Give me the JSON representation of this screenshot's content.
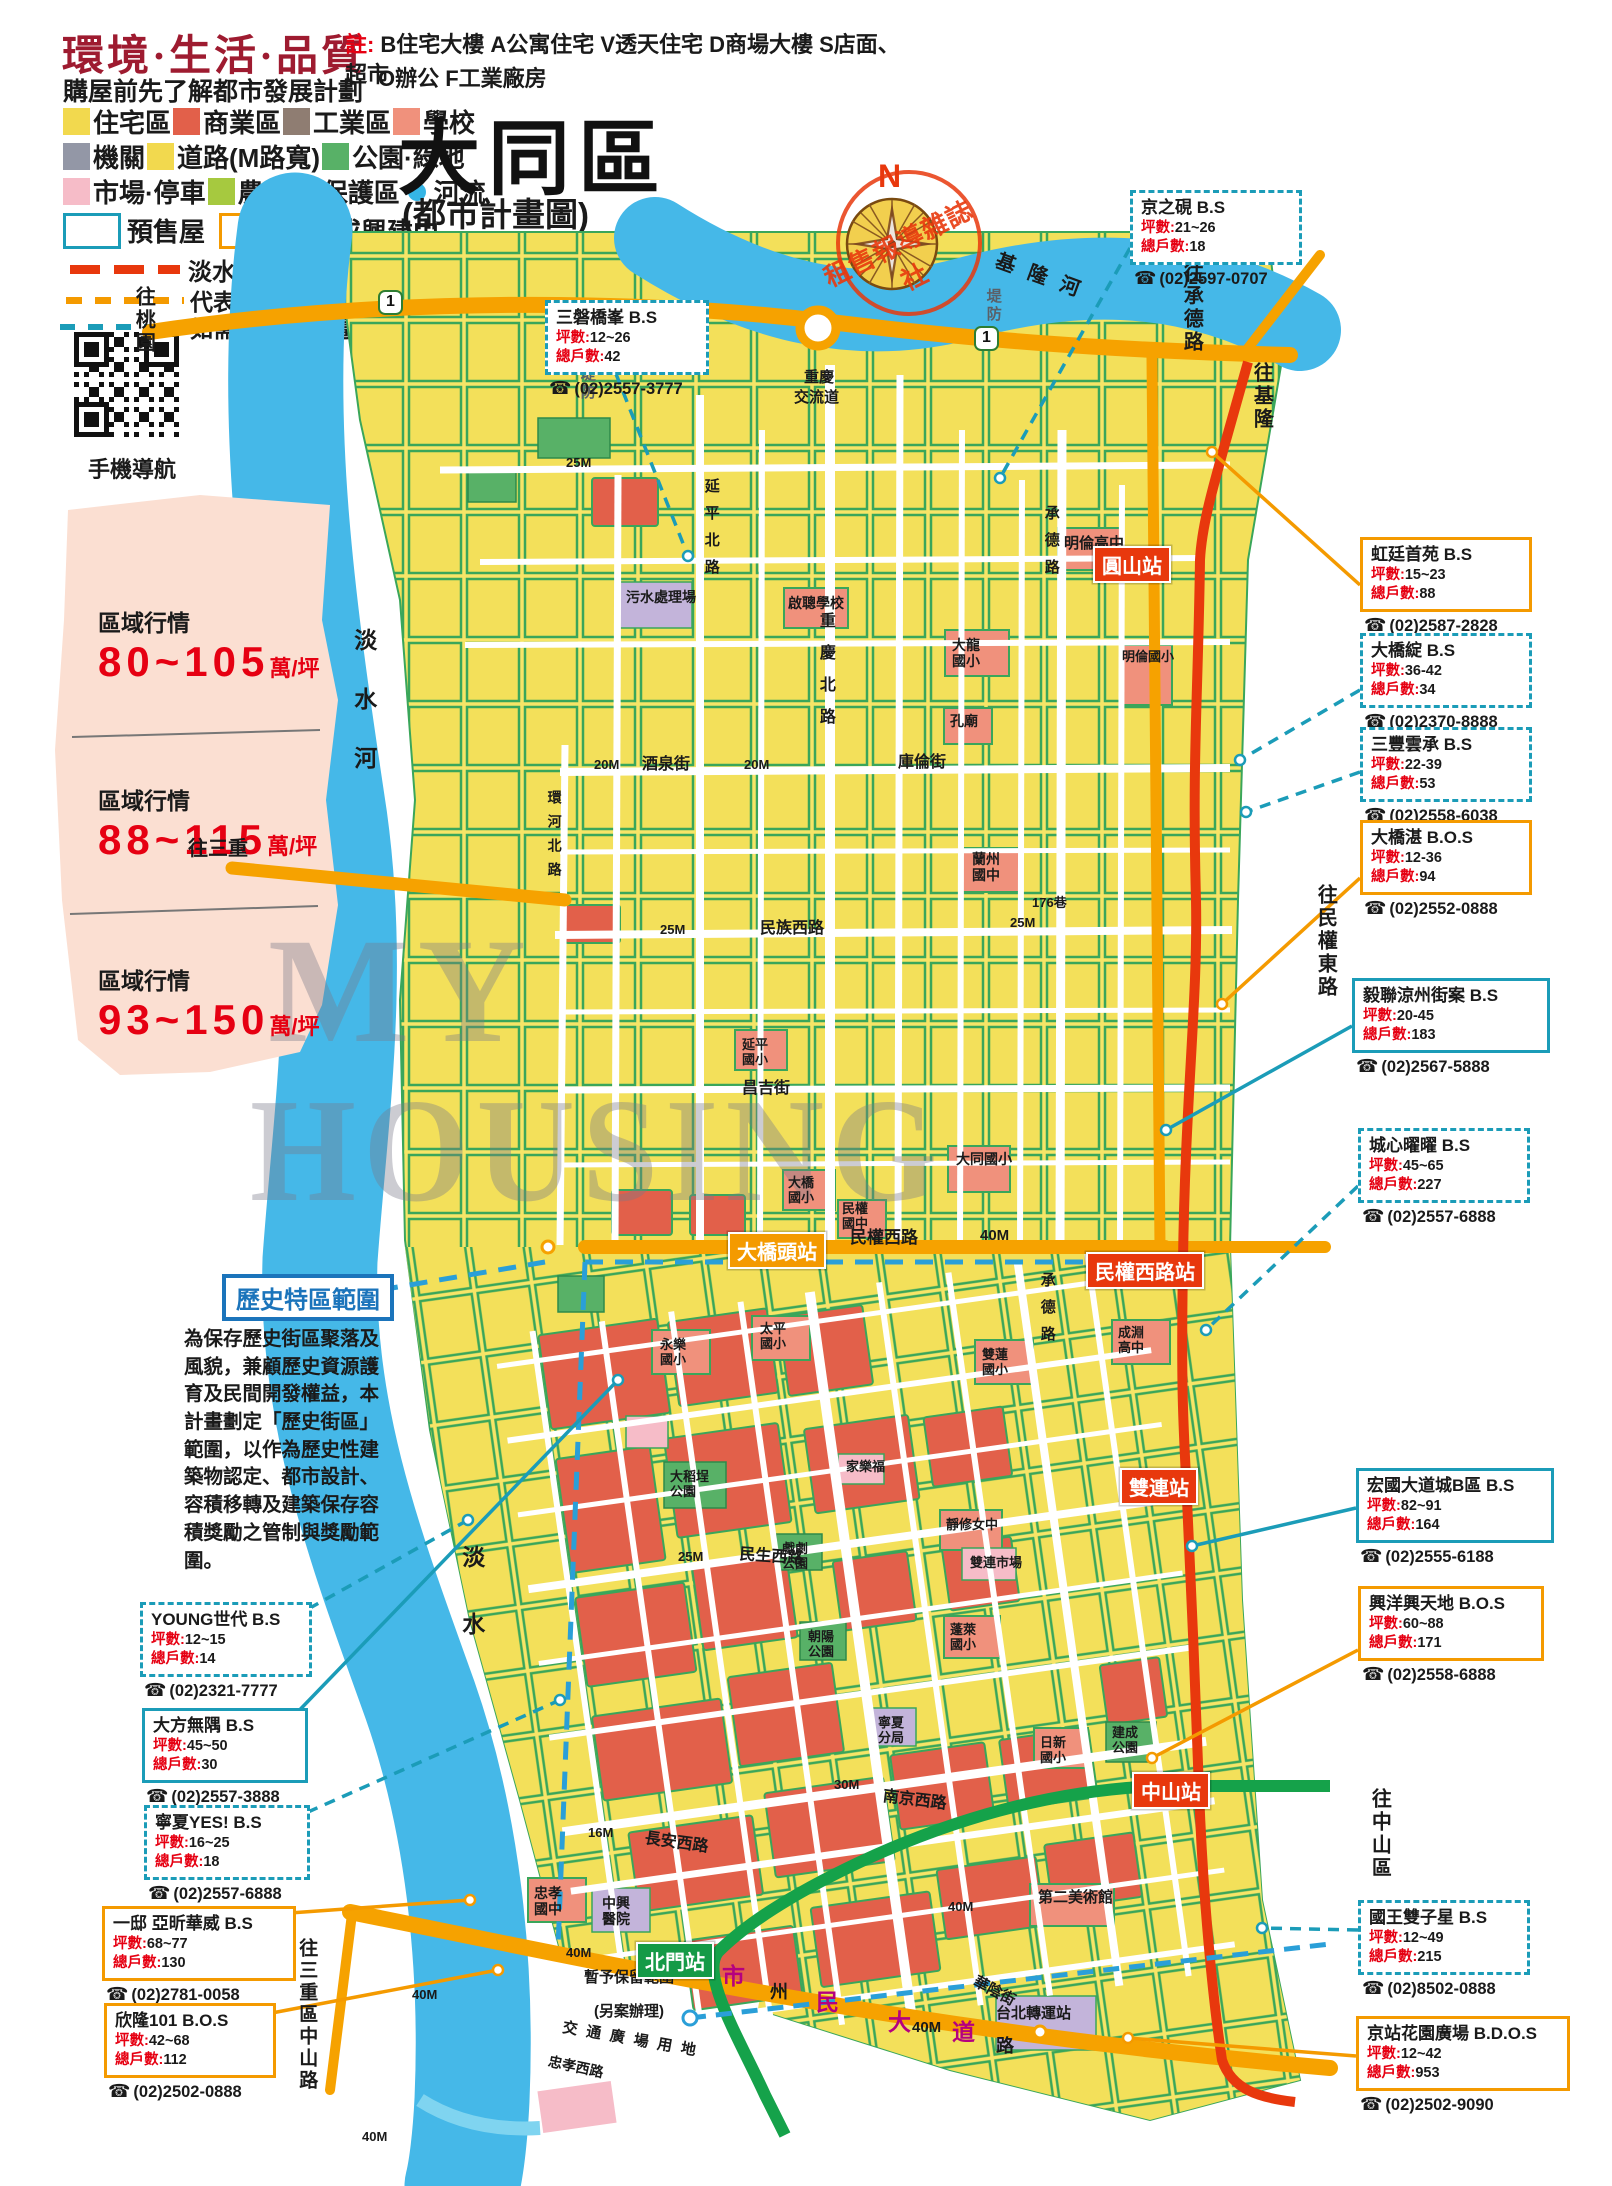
{
  "header": {
    "title": "環境·生活·品質",
    "subtitle": "購屋前先了解都市發展計劃",
    "note_label": "註:",
    "note1": "B住宅大樓 A公寓住宅 V透天住宅 D商場大樓 S店面、超市",
    "note2": "O辦公 F工業廠房",
    "qr_label": "手機導航"
  },
  "map_title": {
    "main": "大同區",
    "sub": "(都市計畫圖)",
    "compass_n": "N",
    "stamp": "租售報導雜誌社"
  },
  "legend": {
    "rows": [
      {
        "items": [
          {
            "sw": "#f2d94e",
            "label": "住宅區"
          },
          {
            "sw": "#e2604a",
            "label": "商業區"
          },
          {
            "sw": "#8f7d72",
            "label": "工業區"
          },
          {
            "sw": "#f0917c",
            "label": "學校"
          }
        ]
      },
      {
        "items": [
          {
            "sw": "#9397a6",
            "label": "機關"
          },
          {
            "sw": "#f2d94e",
            "label": "道路(M路寬)"
          },
          {
            "sw": "#58b167",
            "label": "公園·綠地"
          }
        ]
      },
      {
        "items": [
          {
            "sw": "#f6bcc8",
            "label": "市場·停車"
          },
          {
            "sw": "#a6c93f",
            "label": "農業"
          },
          {
            "sw": "dots",
            "label": "保護區"
          },
          {
            "sw": "drop",
            "label": "河流"
          }
        ]
      }
    ],
    "presale": {
      "color": "#1b9cb8",
      "label": "預售屋"
    },
    "built": {
      "color": "#f49a00",
      "label": "成屋或興建中"
    },
    "mrt_label": "淡水線／信義線",
    "note1": "代表接待中心不在基地位置上，",
    "note2": "如需前往請先電洽。"
  },
  "price_zones": [
    {
      "label": "區域行情",
      "range": "80~105",
      "unit": "萬/坪"
    },
    {
      "label": "區域行情",
      "range": "88~115",
      "unit": "萬/坪"
    },
    {
      "label": "區域行情",
      "range": "93~150",
      "unit": "萬/坪"
    }
  ],
  "historic": {
    "title": "歷史特區範圍",
    "body": "為保存歷史街區聚落及風貌，兼顧歷史資源護育及民間開發權益，本計畫劃定「歷史街區」範圍，以作為歷史性建築物認定、都市設計、容積移轉及建築保存容積獎勵之管制與獎勵範圍。"
  },
  "watermark": {
    "line1": "MY",
    "line2": "HOUSING"
  },
  "fields": {
    "ping": "坪數:",
    "units": "總戶數:",
    "phone_icon": "☎"
  },
  "colors": {
    "accent_red": "#e8380d",
    "accent_orange": "#f49a00",
    "accent_teal": "#1b9cb8",
    "price_red": "#e60012",
    "title_red": "#9e1b30",
    "historic_blue": "#1b74bb"
  },
  "listings": [
    {
      "name": "京之硯",
      "grade": "B.S",
      "ping": "21~26",
      "units": "18",
      "phone": "(02)2597-0707",
      "style": "d",
      "x": 1130,
      "y": 190,
      "w": 150,
      "lx": 1130,
      "ly": 248,
      "tx": 1000,
      "ty": 478
    },
    {
      "name": "三磐橋峯",
      "grade": "B.S",
      "ping": "12~26",
      "units": "42",
      "phone": "(02)2557-3777",
      "style": "d",
      "x": 545,
      "y": 300,
      "w": 142,
      "lx": 616,
      "ly": 374,
      "tx": 688,
      "ty": 556
    },
    {
      "name": "虹廷首苑",
      "grade": "B.S",
      "ping": "15~23",
      "units": "88",
      "phone": "(02)2587-2828",
      "style": "o",
      "x": 1360,
      "y": 537,
      "w": 150,
      "lx": 1360,
      "ly": 585,
      "tx": 1212,
      "ty": 452
    },
    {
      "name": "大橋綻",
      "grade": "B.S",
      "ping": "36-42",
      "units": "34",
      "phone": "(02)2370-8888",
      "style": "d",
      "x": 1360,
      "y": 633,
      "w": 150,
      "lx": 1360,
      "ly": 690,
      "tx": 1240,
      "ty": 760
    },
    {
      "name": "三豐雲承",
      "grade": "B.S",
      "ping": "22-39",
      "units": "53",
      "phone": "(02)2558-6038",
      "style": "d",
      "x": 1360,
      "y": 727,
      "w": 150,
      "lx": 1360,
      "ly": 772,
      "tx": 1246,
      "ty": 812
    },
    {
      "name": "大橋湛",
      "grade": "B.O.S",
      "ping": "12-36",
      "units": "94",
      "phone": "(02)2552-0888",
      "style": "o",
      "x": 1360,
      "y": 820,
      "w": 150,
      "lx": 1360,
      "ly": 878,
      "tx": 1222,
      "ty": 1004
    },
    {
      "name": "毅聯涼州街案",
      "grade": "B.S",
      "ping": "20-45",
      "units": "183",
      "phone": "(02)2567-5888",
      "style": "t",
      "x": 1352,
      "y": 978,
      "w": 176,
      "lx": 1352,
      "ly": 1026,
      "tx": 1166,
      "ty": 1130
    },
    {
      "name": "城心曜曜",
      "grade": "B.S",
      "ping": "45~65",
      "units": "227",
      "phone": "(02)2557-6888",
      "style": "d",
      "x": 1358,
      "y": 1128,
      "w": 150,
      "lx": 1358,
      "ly": 1186,
      "tx": 1206,
      "ty": 1330
    },
    {
      "name": "宏國大道城B區",
      "grade": "B.S",
      "ping": "82~91",
      "units": "164",
      "phone": "(02)2555-6188",
      "style": "t",
      "x": 1356,
      "y": 1468,
      "w": 176,
      "lx": 1356,
      "ly": 1508,
      "tx": 1192,
      "ty": 1546
    },
    {
      "name": "興洋興天地",
      "grade": "B.O.S",
      "ping": "60~88",
      "units": "171",
      "phone": "(02)2558-6888",
      "style": "o",
      "x": 1358,
      "y": 1586,
      "w": 164,
      "lx": 1358,
      "ly": 1650,
      "tx": 1152,
      "ty": 1758
    },
    {
      "name": "國王雙子星",
      "grade": "B.S",
      "ping": "12~49",
      "units": "215",
      "phone": "(02)8502-0888",
      "style": "d",
      "x": 1358,
      "y": 1900,
      "w": 150,
      "lx": 1358,
      "ly": 1930,
      "tx": 1262,
      "ty": 1928
    },
    {
      "name": "京站花園廣場",
      "grade": "B.D.O.S",
      "ping": "12~42",
      "units": "953",
      "phone": "(02)2502-9090",
      "style": "o",
      "x": 1356,
      "y": 2016,
      "w": 192,
      "lx": 1356,
      "ly": 2056,
      "tx": 1128,
      "ty": 2038
    },
    {
      "name": "YOUNG世代",
      "grade": "B.S",
      "ping": "12~15",
      "units": "14",
      "phone": "(02)2321-7777",
      "style": "d",
      "x": 140,
      "y": 1602,
      "w": 150,
      "lx": 292,
      "ly": 1618,
      "tx": 468,
      "ty": 1520
    },
    {
      "name": "大方無隅",
      "grade": "B.S",
      "ping": "45~50",
      "units": "30",
      "phone": "(02)2557-3888",
      "style": "t",
      "x": 142,
      "y": 1708,
      "w": 144,
      "lx": 288,
      "ly": 1722,
      "tx": 618,
      "ty": 1380
    },
    {
      "name": "寧夏YES!",
      "grade": "B.S",
      "ping": "16~25",
      "units": "18",
      "phone": "(02)2557-6888",
      "style": "d",
      "x": 144,
      "y": 1805,
      "w": 144,
      "lx": 290,
      "ly": 1820,
      "tx": 560,
      "ty": 1700
    },
    {
      "name": "一邸 亞昕華威",
      "grade": "B.S",
      "ping": "68~77",
      "units": "130",
      "phone": "(02)2781-0058",
      "style": "o",
      "x": 102,
      "y": 1906,
      "w": 172,
      "lx": 276,
      "ly": 1914,
      "tx": 470,
      "ty": 1900
    },
    {
      "name": "欣隆101",
      "grade": "B.O.S",
      "ping": "42~68",
      "units": "112",
      "phone": "(02)2502-0888",
      "style": "o",
      "x": 104,
      "y": 2003,
      "w": 150,
      "lx": 256,
      "ly": 2016,
      "tx": 498,
      "ty": 1970
    }
  ],
  "stations": [
    {
      "label": "圓山站",
      "x": 1093,
      "y": 546,
      "cls": "st-red"
    },
    {
      "label": "大橋頭站",
      "x": 728,
      "y": 1232,
      "cls": "st-orange"
    },
    {
      "label": "民權西路站",
      "x": 1086,
      "y": 1252,
      "cls": "st-red"
    },
    {
      "label": "雙連站",
      "x": 1120,
      "y": 1468,
      "cls": "st-red"
    },
    {
      "label": "中山站",
      "x": 1132,
      "y": 1772,
      "cls": "st-red"
    },
    {
      "label": "北門站",
      "x": 636,
      "y": 1942,
      "cls": "st-green"
    }
  ],
  "map_labels": [
    {
      "t": "往桃園",
      "x": 132,
      "y": 286,
      "fs": 20,
      "v": 1
    },
    {
      "t": "往承德路",
      "x": 1180,
      "y": 262,
      "fs": 20,
      "v": 1
    },
    {
      "t": "往基隆",
      "x": 1250,
      "y": 362,
      "fs": 20,
      "v": 1
    },
    {
      "t": "往三重",
      "x": 188,
      "y": 838,
      "fs": 20
    },
    {
      "t": "往民權東路",
      "x": 1314,
      "y": 884,
      "fs": 20,
      "v": 1
    },
    {
      "t": "往中山區",
      "x": 1368,
      "y": 1788,
      "fs": 20,
      "v": 1
    },
    {
      "t": "往三重區中山路",
      "x": 296,
      "y": 1938,
      "fs": 19,
      "v": 1
    },
    {
      "t": "淡水河",
      "x": 350,
      "y": 628,
      "fs": 23,
      "v": 1,
      "sp": 36
    },
    {
      "t": "淡水",
      "x": 458,
      "y": 1545,
      "fs": 23,
      "v": 1,
      "sp": 44
    },
    {
      "t": "基隆河",
      "x": 1000,
      "y": 250,
      "fs": 20,
      "r": 20,
      "sp": 14
    },
    {
      "t": "堤防",
      "x": 578,
      "y": 366,
      "fs": 15,
      "v": 1,
      "c": "grey"
    },
    {
      "t": "堤防",
      "x": 984,
      "y": 288,
      "fs": 15,
      "v": 1,
      "c": "grey"
    },
    {
      "t": "忠孝大橋",
      "x": 238,
      "y": 1918,
      "fs": 15,
      "r": 55
    },
    {
      "t": "1",
      "x": 378,
      "y": 290,
      "fs": 16,
      "c": "shield"
    },
    {
      "t": "1",
      "x": 974,
      "y": 326,
      "fs": 16,
      "c": "shield"
    },
    {
      "t": "重慶",
      "x": 804,
      "y": 370,
      "fs": 15
    },
    {
      "t": "交流道",
      "x": 794,
      "y": 390,
      "fs": 15
    },
    {
      "t": "25M",
      "x": 566,
      "y": 456,
      "fs": 13
    },
    {
      "t": "20M",
      "x": 594,
      "y": 758,
      "fs": 13
    },
    {
      "t": "酒泉街",
      "x": 642,
      "y": 756,
      "fs": 16
    },
    {
      "t": "20M",
      "x": 744,
      "y": 758,
      "fs": 13
    },
    {
      "t": "庫倫街",
      "x": 898,
      "y": 754,
      "fs": 16
    },
    {
      "t": "25M",
      "x": 660,
      "y": 923,
      "fs": 13
    },
    {
      "t": "民族西路",
      "x": 760,
      "y": 920,
      "fs": 16
    },
    {
      "t": "25M",
      "x": 1010,
      "y": 916,
      "fs": 13
    },
    {
      "t": "昌吉街",
      "x": 742,
      "y": 1080,
      "fs": 16
    },
    {
      "t": "40M",
      "x": 794,
      "y": 1230,
      "fs": 15
    },
    {
      "t": "民權西路",
      "x": 850,
      "y": 1228,
      "fs": 17
    },
    {
      "t": "40M",
      "x": 980,
      "y": 1228,
      "fs": 15
    },
    {
      "t": "25M",
      "x": 678,
      "y": 1550,
      "fs": 13
    },
    {
      "t": "民生西路",
      "x": 740,
      "y": 1546,
      "fs": 16,
      "r": 4
    },
    {
      "t": "30M",
      "x": 834,
      "y": 1778,
      "fs": 13
    },
    {
      "t": "南京西路",
      "x": 884,
      "y": 1788,
      "fs": 16,
      "r": 7
    },
    {
      "t": "16M",
      "x": 588,
      "y": 1826,
      "fs": 13
    },
    {
      "t": "長安西路",
      "x": 646,
      "y": 1830,
      "fs": 16,
      "r": 8
    },
    {
      "t": "華陰街",
      "x": 978,
      "y": 1974,
      "fs": 15,
      "r": 28
    },
    {
      "t": "市",
      "x": 722,
      "y": 1964,
      "fs": 23,
      "c": "mag"
    },
    {
      "t": "州",
      "x": 770,
      "y": 1982,
      "fs": 18
    },
    {
      "t": "民",
      "x": 816,
      "y": 1990,
      "fs": 23,
      "c": "mag"
    },
    {
      "t": "大",
      "x": 888,
      "y": 2010,
      "fs": 23,
      "c": "mag"
    },
    {
      "t": "40M",
      "x": 912,
      "y": 2020,
      "fs": 15
    },
    {
      "t": "道",
      "x": 952,
      "y": 2020,
      "fs": 23,
      "c": "mag"
    },
    {
      "t": "路",
      "x": 996,
      "y": 2036,
      "fs": 18
    },
    {
      "t": "40M",
      "x": 948,
      "y": 1900,
      "fs": 13
    },
    {
      "t": "40M",
      "x": 566,
      "y": 1946,
      "fs": 13
    },
    {
      "t": "40M",
      "x": 412,
      "y": 1988,
      "fs": 13
    },
    {
      "t": "40M",
      "x": 362,
      "y": 2130,
      "fs": 13
    },
    {
      "t": "重慶北路",
      "x": 816,
      "y": 612,
      "fs": 16,
      "v": 1,
      "sp": 16
    },
    {
      "t": "延平北路",
      "x": 702,
      "y": 478,
      "fs": 15,
      "v": 1,
      "sp": 12
    },
    {
      "t": "承德路",
      "x": 1042,
      "y": 505,
      "fs": 15,
      "v": 1,
      "sp": 12
    },
    {
      "t": "承德路",
      "x": 1038,
      "y": 1272,
      "fs": 15,
      "v": 1,
      "sp": 12
    },
    {
      "t": "環河北路",
      "x": 546,
      "y": 790,
      "fs": 14,
      "v": 1,
      "sp": 10
    },
    {
      "t": "176巷",
      "x": 1032,
      "y": 896,
      "fs": 13
    },
    {
      "t": "污水處理場",
      "x": 626,
      "y": 590,
      "fs": 14
    },
    {
      "t": "啟聰學校",
      "x": 788,
      "y": 596,
      "fs": 14
    },
    {
      "t": "明倫高中",
      "x": 1064,
      "y": 536,
      "fs": 15
    },
    {
      "t": "明倫國小",
      "x": 1122,
      "y": 650,
      "fs": 13
    },
    {
      "t": "大龍\n國小",
      "x": 952,
      "y": 638,
      "fs": 14
    },
    {
      "t": "孔廟",
      "x": 950,
      "y": 714,
      "fs": 14
    },
    {
      "t": "蘭州\n國中",
      "x": 972,
      "y": 852,
      "fs": 14
    },
    {
      "t": "大同國小",
      "x": 956,
      "y": 1152,
      "fs": 14
    },
    {
      "t": "延平\n國小",
      "x": 742,
      "y": 1038,
      "fs": 13
    },
    {
      "t": "大橋\n國小",
      "x": 788,
      "y": 1176,
      "fs": 13
    },
    {
      "t": "民權\n國中",
      "x": 842,
      "y": 1202,
      "fs": 13
    },
    {
      "t": "永樂\n國小",
      "x": 660,
      "y": 1338,
      "fs": 13
    },
    {
      "t": "太平\n國小",
      "x": 760,
      "y": 1322,
      "fs": 13
    },
    {
      "t": "雙蓮\n國小",
      "x": 982,
      "y": 1348,
      "fs": 13
    },
    {
      "t": "成淵\n高中",
      "x": 1118,
      "y": 1326,
      "fs": 13
    },
    {
      "t": "大稻埕\n公園",
      "x": 670,
      "y": 1470,
      "fs": 13
    },
    {
      "t": "家樂福",
      "x": 846,
      "y": 1460,
      "fs": 13
    },
    {
      "t": "靜修女中",
      "x": 946,
      "y": 1518,
      "fs": 13
    },
    {
      "t": "戲劇\n公園",
      "x": 782,
      "y": 1542,
      "fs": 13
    },
    {
      "t": "雙連市場",
      "x": 970,
      "y": 1556,
      "fs": 13
    },
    {
      "t": "蓬萊\n國小",
      "x": 950,
      "y": 1623,
      "fs": 13
    },
    {
      "t": "朝陽\n公園",
      "x": 808,
      "y": 1630,
      "fs": 13
    },
    {
      "t": "寧夏\n分局",
      "x": 878,
      "y": 1716,
      "fs": 13
    },
    {
      "t": "日新\n國小",
      "x": 1040,
      "y": 1736,
      "fs": 13
    },
    {
      "t": "建成\n公園",
      "x": 1112,
      "y": 1726,
      "fs": 13
    },
    {
      "t": "第二美術館",
      "x": 1038,
      "y": 1890,
      "fs": 15
    },
    {
      "t": "中興\n醫院",
      "x": 602,
      "y": 1896,
      "fs": 14
    },
    {
      "t": "忠孝\n國中",
      "x": 534,
      "y": 1886,
      "fs": 14
    },
    {
      "t": "台北轉運站",
      "x": 996,
      "y": 2006,
      "fs": 15
    },
    {
      "t": "暫予保留範圍",
      "x": 584,
      "y": 1970,
      "fs": 15
    },
    {
      "t": "(另案辦理)",
      "x": 594,
      "y": 2004,
      "fs": 15
    },
    {
      "t": "交通廣場用地",
      "x": 564,
      "y": 2020,
      "fs": 15,
      "r": 10,
      "sp": 9
    },
    {
      "t": "忠孝西路",
      "x": 550,
      "y": 2054,
      "fs": 14,
      "r": 12
    }
  ]
}
